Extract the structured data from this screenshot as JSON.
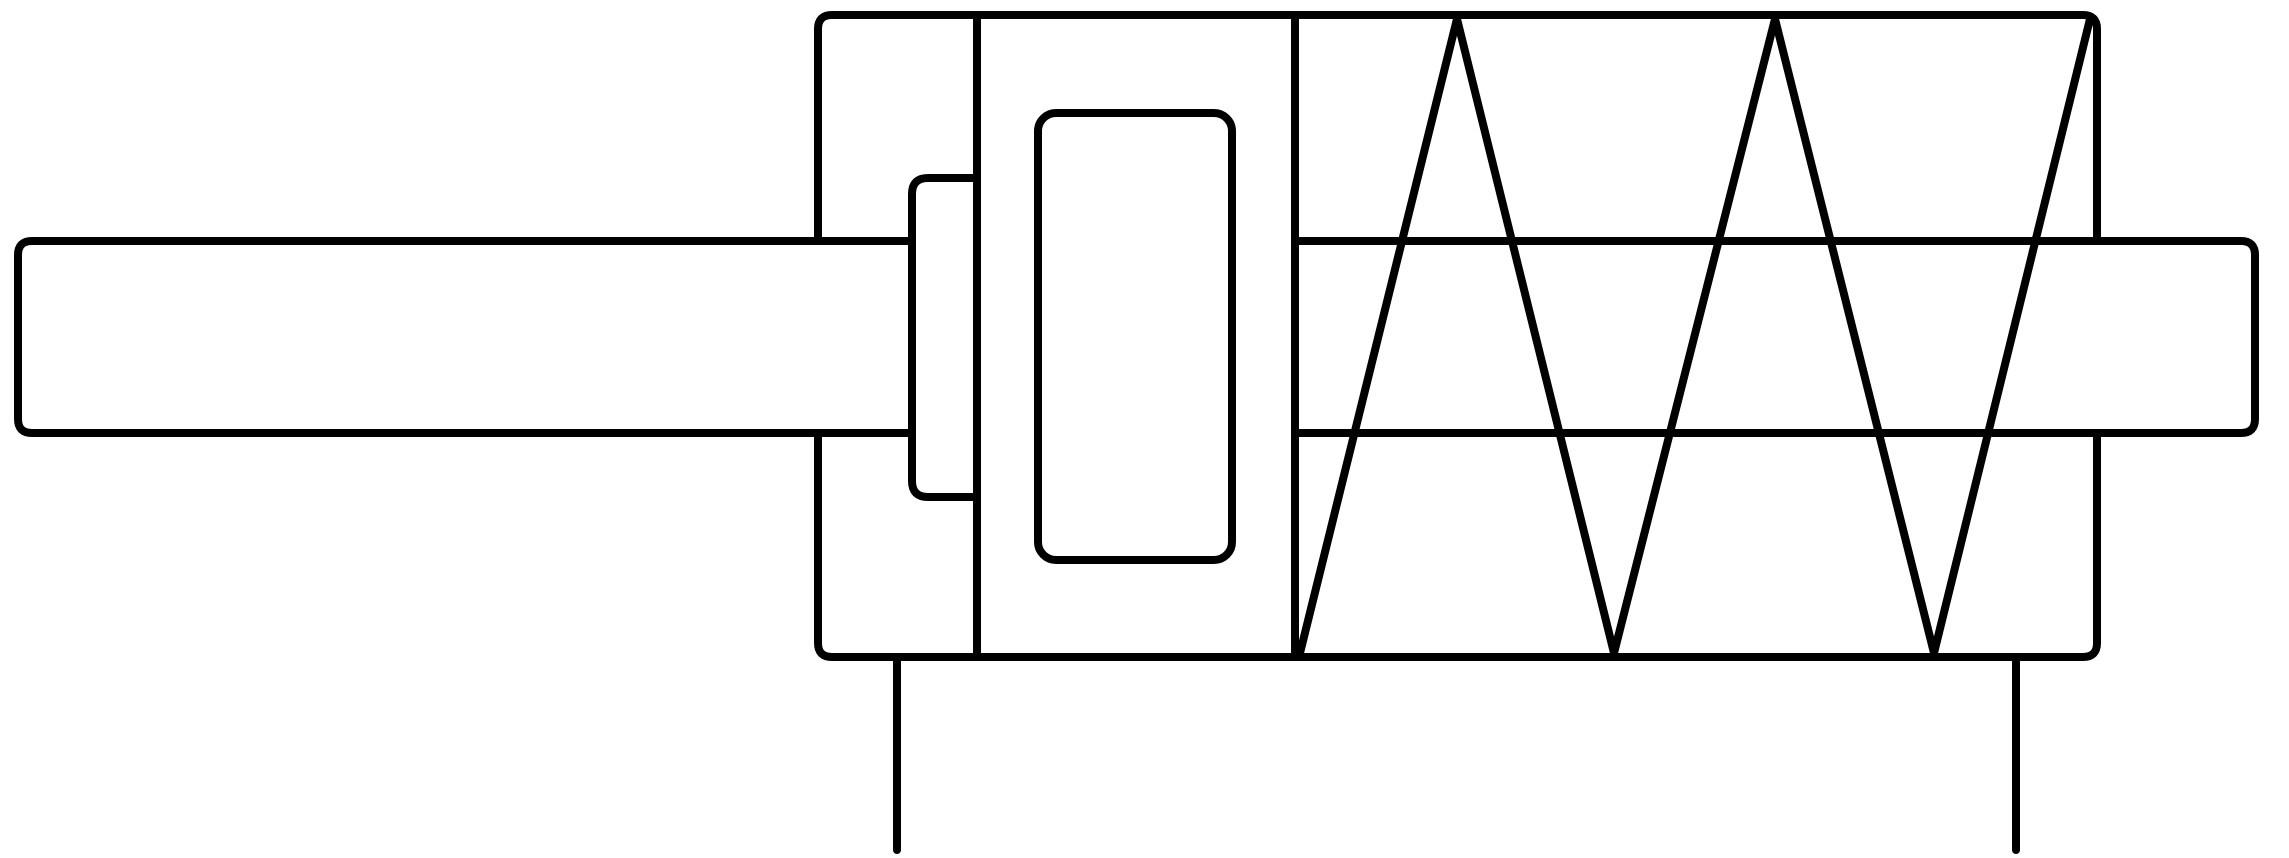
{
  "page": {
    "background_color": "#ffffff"
  },
  "diagram": {
    "canvas": {
      "width": 2289,
      "height": 858
    },
    "stroke": {
      "color": "#000000",
      "width": 8,
      "linecap": "round",
      "linejoin": "round"
    },
    "shapes": [
      {
        "name": "piston-rod-left-segment",
        "type": "path",
        "d": "M 912 241 L 32 241 Q 18 241 18 255 L 18 419 Q 18 433 32 433 L 912 433"
      },
      {
        "name": "piston-rod-right-segment",
        "type": "path",
        "d": "M 1295 241 L 2241 241 Q 2255 241 2255 255 L 2255 419 Q 2255 433 2241 433 L 1295 433"
      },
      {
        "name": "cylinder-body-upper-outline",
        "type": "path",
        "d": "M 818 241 L 818 29 Q 818 15 832 15 L 2083 15 Q 2097 15 2097 29 L 2097 241"
      },
      {
        "name": "cylinder-body-lower-outline",
        "type": "path",
        "d": "M 2097 433 L 2097 643 Q 2097 657 2083 657 L 832 657 Q 818 657 818 643 L 818 433"
      },
      {
        "name": "piston-left-wall",
        "type": "line",
        "x1": 977,
        "y1": 15,
        "x2": 977,
        "y2": 657
      },
      {
        "name": "piston-right-wall",
        "type": "line",
        "x1": 1295,
        "y1": 15,
        "x2": 1295,
        "y2": 657
      },
      {
        "name": "rod-side-flange",
        "type": "path",
        "d": "M 977 178 L 928 178 Q 912 178 912 194 L 912 481 Q 912 497 928 497 L 977 497"
      },
      {
        "name": "cushion-spool",
        "type": "rect",
        "x": 1038,
        "y": 113,
        "width": 194,
        "height": 447,
        "rx": 18
      },
      {
        "name": "return-spring",
        "type": "polyline",
        "points": [
          [
            1300,
            653
          ],
          [
            1457,
            19
          ],
          [
            1614,
            653
          ],
          [
            1775,
            19
          ],
          [
            1934,
            653
          ],
          [
            2090,
            19
          ]
        ]
      },
      {
        "name": "port-stub-left",
        "type": "line",
        "x1": 897,
        "y1": 657,
        "x2": 897,
        "y2": 850
      },
      {
        "name": "port-stub-right",
        "type": "line",
        "x1": 2016,
        "y1": 657,
        "x2": 2016,
        "y2": 850
      }
    ]
  }
}
